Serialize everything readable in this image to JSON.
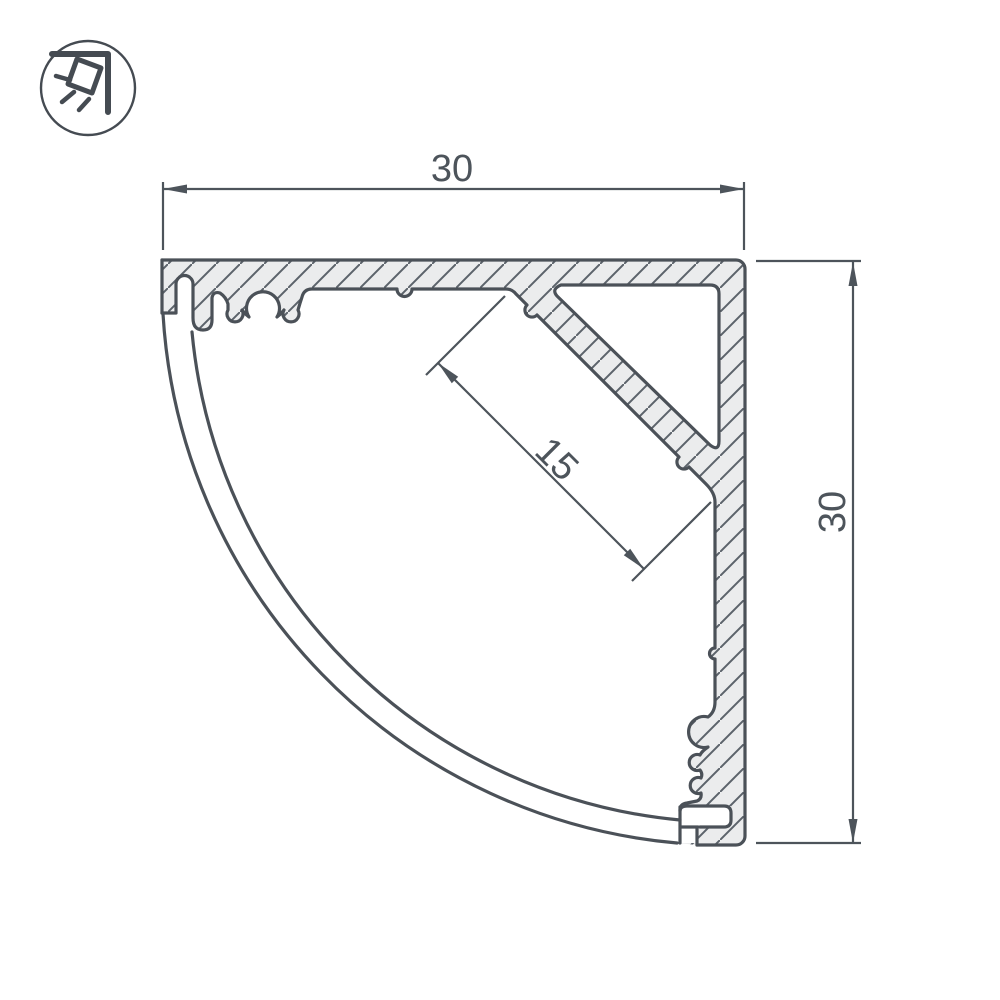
{
  "meta": {
    "subject": "Technical cross-section drawing of an aluminum corner LED profile with quarter-circle diffuser cover"
  },
  "dimensions": {
    "top_width": "30",
    "right_height": "30",
    "diagonal_seat": "15"
  },
  "icon": {
    "name": "corner-light-icon"
  },
  "colors": {
    "background": "#ffffff",
    "outline": "#4b5158",
    "aluminum_fill": "#ebeced",
    "hatch_line": "#5c636b",
    "dimension": "#4d545b"
  }
}
